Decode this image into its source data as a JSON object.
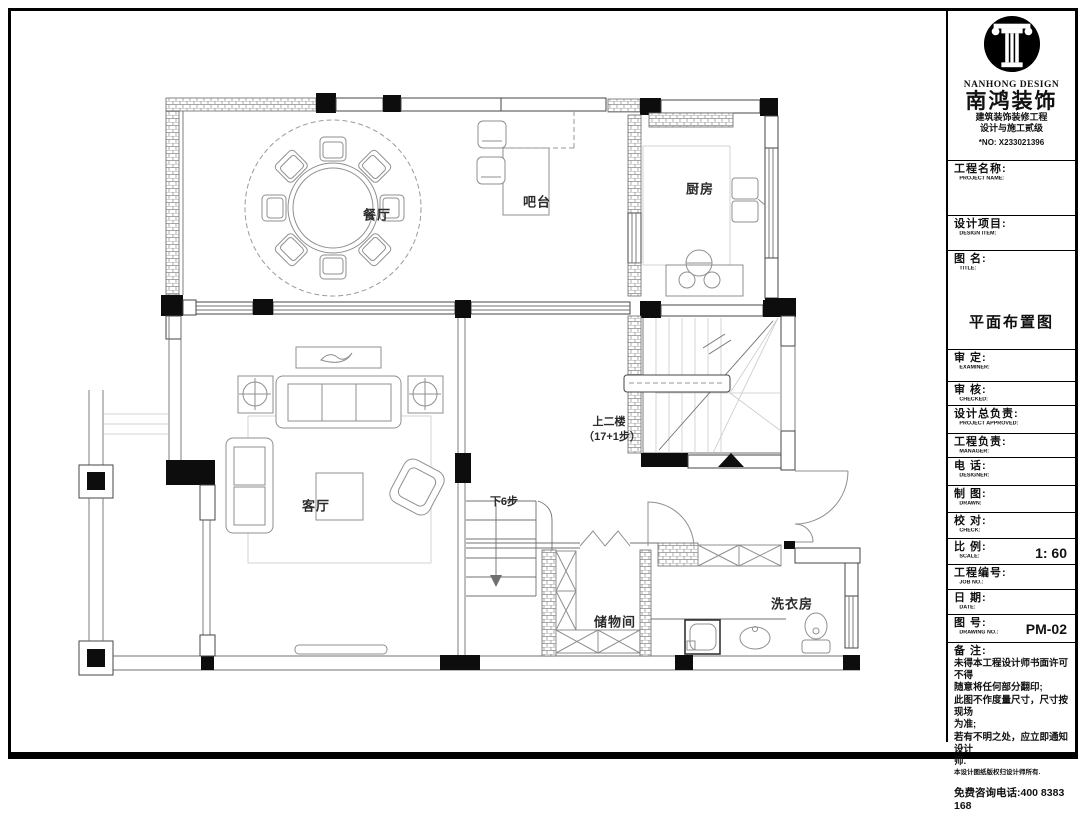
{
  "brand": {
    "logo_en": "NANHONG DESIGN",
    "logo_cn": "南鸿装饰",
    "cert_line1": "建筑装饰装修工程",
    "cert_line2": "设计与施工贰级",
    "cert_no": "*NO: X233021396",
    "hotline": "免费咨询电话:400 8383 168"
  },
  "title_block": {
    "project_name": {
      "cn": "工程名称:",
      "en": "PROJECT NAME:"
    },
    "design_item": {
      "cn": "设计项目:",
      "en": "DESIGN ITEM:"
    },
    "drawing_title": {
      "cn": "图  名:",
      "en": "TITLE:",
      "value": "平面布置图"
    },
    "examiner": {
      "cn": "审  定:",
      "en": "EXAMINER:"
    },
    "checked": {
      "cn": "审  核:",
      "en": "CHECKED:"
    },
    "project_approved": {
      "cn": "设计总负责:",
      "en": "PROJECT APPROVED:"
    },
    "manager": {
      "cn": "工程负责:",
      "en": "MANAGER:"
    },
    "designer": {
      "cn": "电  话:",
      "en": "DESIGNER:"
    },
    "drawn": {
      "cn": "制  图:",
      "en": "DRAWN:"
    },
    "check": {
      "cn": "校  对:",
      "en": "CHECK:"
    },
    "scale": {
      "cn": "比  例:",
      "en": "SCALE:",
      "value": "1: 60"
    },
    "job_no": {
      "cn": "工程编号:",
      "en": "JOB NO.:"
    },
    "date": {
      "cn": "日  期:",
      "en": "DATE:"
    },
    "drawing_no": {
      "cn": "图  号:",
      "en": "DRAWING NO.:",
      "value": "PM-02"
    },
    "notes": {
      "cn": "备  注:",
      "lines": [
        "未得本工程设计师书面许可不得",
        "随意将任何部分翻印;",
        "此图不作度量尺寸，尺寸按现场",
        "为准;",
        "若有不明之处，应立即通知设计",
        "师.",
        "本设计图纸版权归设计师所有."
      ]
    }
  },
  "plan": {
    "labels": {
      "dining": "餐厅",
      "bar": "吧台",
      "kitchen": "厨房",
      "living": "客厅",
      "storage": "储物间",
      "laundry": "洗衣房",
      "stairs_up": "上二楼",
      "stairs_up_steps": "（17+1步）",
      "steps_down": "下6步"
    }
  }
}
